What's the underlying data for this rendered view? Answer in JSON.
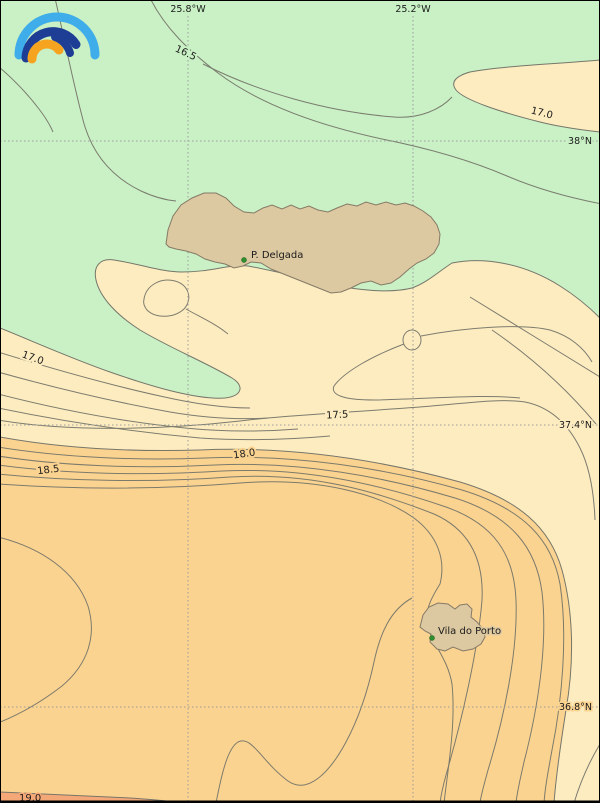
{
  "map": {
    "description": "Sea-surface temperature contour map of the Azores area",
    "logo_name": "rainbow-arcs-logo"
  },
  "grid": {
    "meridians": [
      {
        "label": "25.8°W",
        "x": 188
      },
      {
        "label": "25.2°W",
        "x": 413
      }
    ],
    "parallels": [
      {
        "label": "38°N",
        "y": 141
      },
      {
        "label": "37.4°N",
        "y": 425
      },
      {
        "label": "36.8°N",
        "y": 707
      }
    ]
  },
  "contour_labels": [
    {
      "value": "16.5"
    },
    {
      "value": "17.0"
    },
    {
      "value": "17.0"
    },
    {
      "value": "17.5"
    },
    {
      "value": "18.0"
    },
    {
      "value": "18.5"
    },
    {
      "value": "19.0"
    }
  ],
  "places": [
    {
      "name": "P. Delgada"
    },
    {
      "name": "Vila do Porto"
    }
  ],
  "colors": {
    "band_below_17": "#c9f1c5",
    "band_17_18": "#fdecc0",
    "band_18_19": "#fbd391",
    "band_above_19": "#f5a877",
    "land": "#dcc8a1",
    "land_outline": "#857a66",
    "contour_line": "#76766a",
    "grid_line": "#9d9d9d",
    "label_text": "#1b1b1b",
    "place_marker": "#2f8f2f",
    "logo_light_blue": "#3fadea",
    "logo_navy": "#1d3e94",
    "logo_orange": "#f6a41f"
  }
}
